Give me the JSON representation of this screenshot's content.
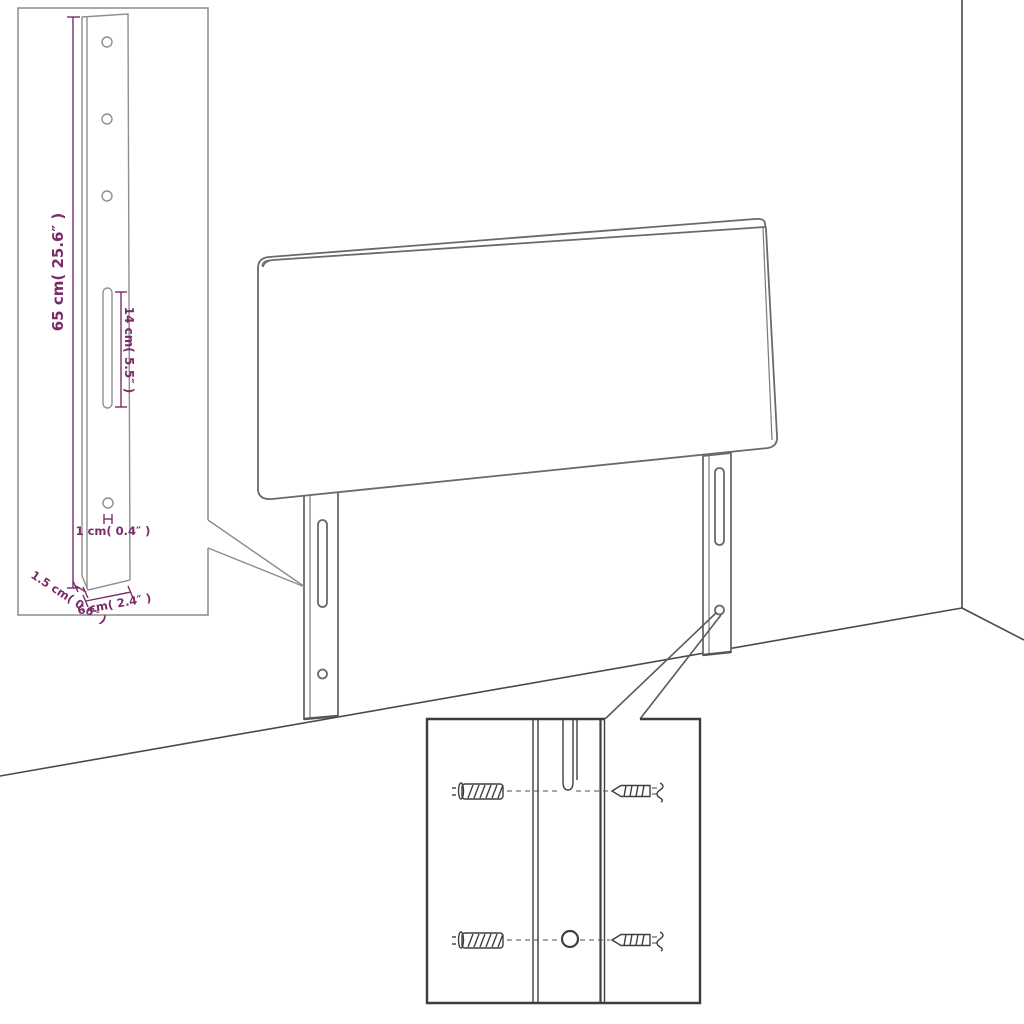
{
  "colors": {
    "background": "#ffffff",
    "furniture_outline": "#6a6a6a",
    "room_line": "#4a4a4a",
    "bracket_inset_border": "#8c8c8c",
    "hardware_inset_border": "#3d3d3d",
    "hardware_ink": "#3f3f3f",
    "dimension": "#7b2b68"
  },
  "bracket_inset": {
    "dimensions": {
      "height": "65 cm( 25.6″ )",
      "slot_length": "14 cm( 5.5″ )",
      "hole_diameter": "1 cm( 0.4″ )",
      "depth": "1.5 cm( 0.6″ )",
      "width": "6 cm( 2.4″ )"
    }
  },
  "hardware_inset": {
    "icons": [
      "wall-plug-icon",
      "screw-icon",
      "wall-plug-icon",
      "screw-icon"
    ]
  }
}
